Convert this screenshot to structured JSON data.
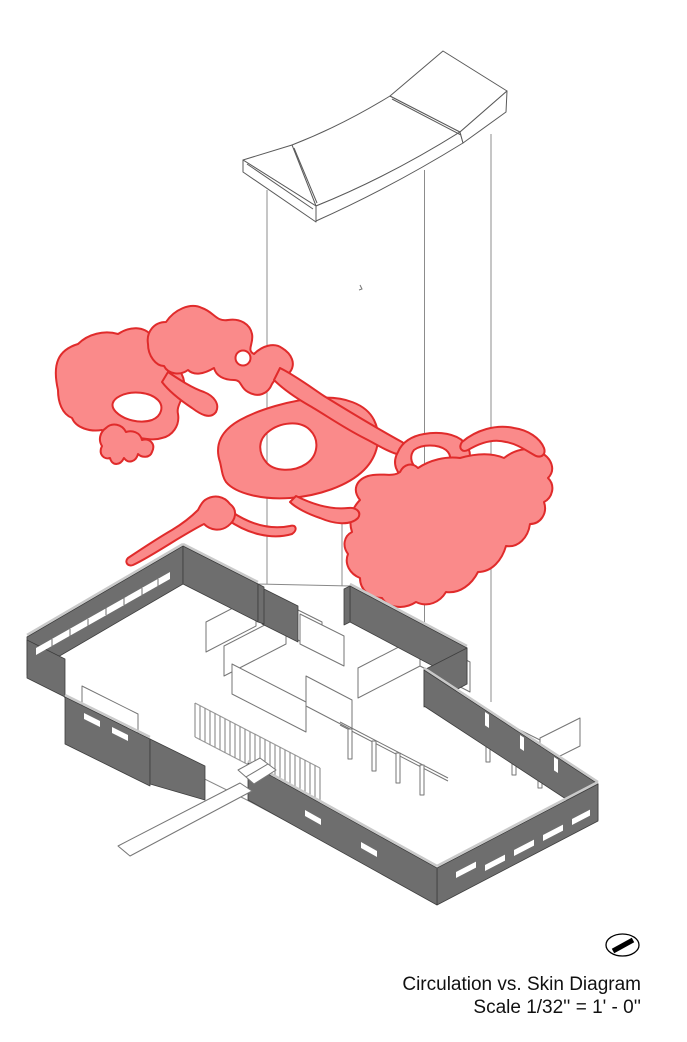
{
  "caption": {
    "title": "Circulation vs. Skin Diagram",
    "scale": "Scale 1/32'' = 1' - 0''"
  },
  "diagram": {
    "type": "exploded axonometric architectural diagram",
    "layers": [
      {
        "id": "roof",
        "description": "butterfly roof slab, white line drawing",
        "line_color": "#5a5a5a"
      },
      {
        "id": "circulation-zones",
        "description": "organic circulation blob plan",
        "fill_color": "#FA8A8A",
        "outline_color": "#E02B2B"
      },
      {
        "id": "building-model",
        "description": "skin / wall model of house",
        "wall_color": "#6E6E6E",
        "wall_edge_color": "#3E3E3E",
        "wall_top_color": "#C9C9C9"
      }
    ],
    "projection_lines": {
      "color": "#8C8C8C",
      "count": 4
    }
  },
  "icons": {
    "north_arrow": "oval with diagonal needle"
  }
}
